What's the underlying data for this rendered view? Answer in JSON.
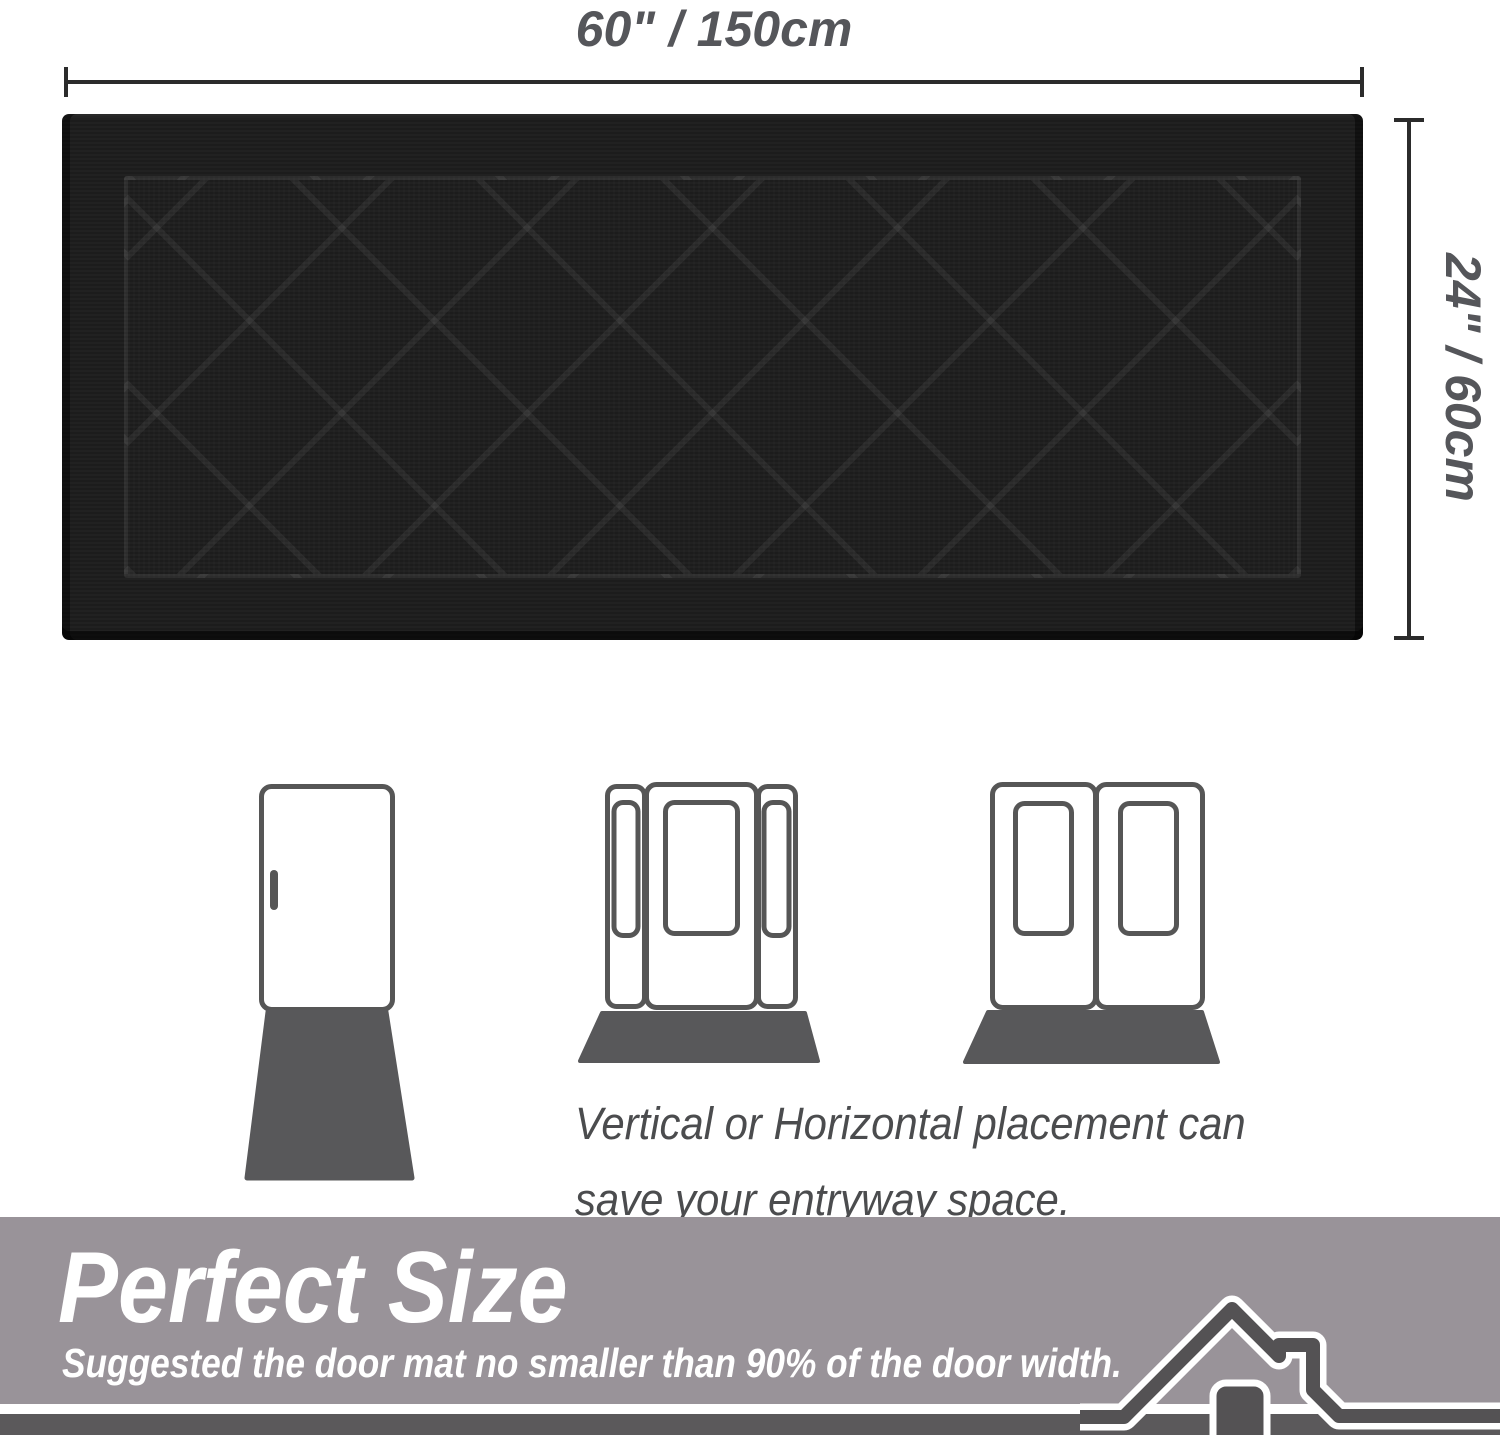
{
  "size_diagram": {
    "width_label": "60\" / 150cm",
    "height_label": "24\" / 60cm",
    "mat_pattern": "diamond-lattice"
  },
  "placement_section": {
    "caption_lines": [
      "Vertical or Horizontal placement can",
      "save your entryway space."
    ],
    "door_icons": [
      "single-door",
      "door-with-sidelights",
      "double-door"
    ]
  },
  "banner": {
    "title": "Perfect Size",
    "subtitle": "Suggested the door mat no smaller than 90% of the door width."
  },
  "colors": {
    "mat_black": "#1c1c1c",
    "placement_mat_gray": "#58585a",
    "door_outline_gray": "#565656",
    "dimension_text": "#55565a",
    "dimension_line": "#2b2b2b",
    "caption_text": "#4b4c4e",
    "banner_background": "#999399",
    "banner_dark_band": "#5b595b",
    "banner_text": "#ffffff",
    "house_roof": "#545254"
  }
}
